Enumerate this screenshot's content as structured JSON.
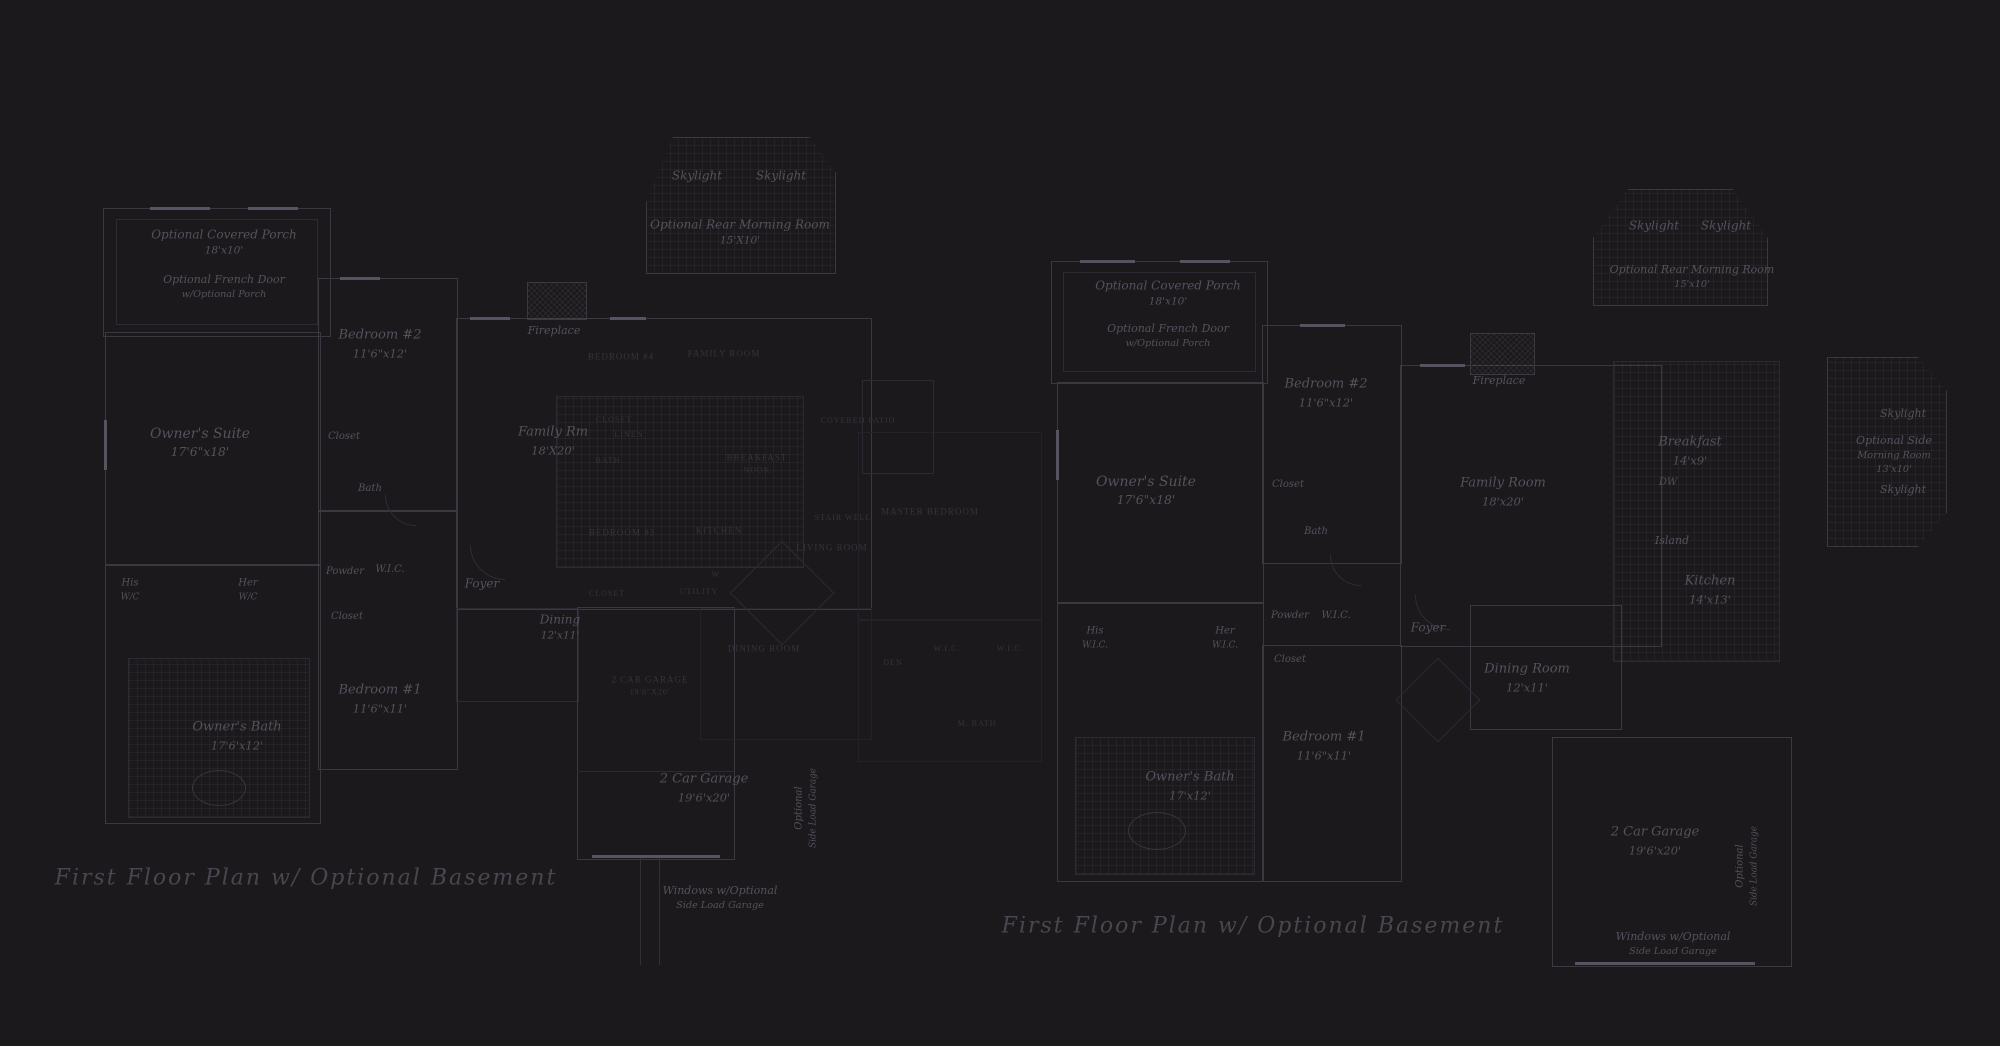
{
  "scene": {
    "description": "Two dark-themed architectural first-floor plan drawings on a charcoal sheet",
    "background_color": "#1b191b",
    "wall_color": "#3b3841",
    "label_color": "#56515e",
    "faded_label_color": "#37333d",
    "title_color": "#4a4550"
  },
  "plans": [
    {
      "id": "left-plan",
      "title": "First Floor Plan  w/ Optional Basement",
      "labels": {
        "skylight_a": [
          "Skylight"
        ],
        "skylight_b": [
          "Skylight"
        ],
        "rear_morning_room": [
          "Optional Rear Morning Room",
          "15'X10'"
        ],
        "covered_porch": [
          "Optional Covered Porch",
          "18'x10'"
        ],
        "french_door": [
          "Optional French Door",
          "w/Optional Porch"
        ],
        "owners_suite": [
          "Owner's Suite",
          "17'6\"x18'"
        ],
        "bedroom_2": [
          "Bedroom #2",
          "11'6\"x12'"
        ],
        "closet_bedroom_2": [
          "Closet"
        ],
        "bath": [
          "Bath"
        ],
        "fireplace": [
          "Fireplace"
        ],
        "family_rm": [
          "Family Rm",
          "18'X20'"
        ],
        "foyer": [
          "Foyer"
        ],
        "dining": [
          "Dining",
          "12'x11'"
        ],
        "bedroom_1": [
          "Bedroom #1",
          "11'6\"x11'"
        ],
        "owners_bath": [
          "Owner's Bath",
          "17'6'x12'"
        ],
        "his_wc": [
          "His",
          "W/C"
        ],
        "her_wc": [
          "Her",
          "W/C"
        ],
        "powder": [
          "Powder"
        ],
        "wic": [
          "W.I.C."
        ],
        "closet_hall": [
          "Closet"
        ],
        "garage": [
          "2 Car Garage",
          "19'6'x20'"
        ],
        "side_load_garage": [
          "Optional",
          "Side Load Garage"
        ],
        "windows_side_load": [
          "Windows w/Optional",
          "Side Load Garage"
        ],
        "ghost_bedroom_4": [
          "BEDROOM #4"
        ],
        "ghost_family_room": [
          "FAMILY ROOM"
        ],
        "ghost_closet": [
          "CLOSET"
        ],
        "ghost_linen": [
          "LINEN"
        ],
        "ghost_bath": [
          "BATH"
        ],
        "ghost_bedroom_3": [
          "BEDROOM #3"
        ],
        "ghost_kitchen": [
          "KITCHEN"
        ],
        "ghost_breakfast_nook": [
          "BREAKFAST",
          "NOOK"
        ],
        "ghost_living_room": [
          "LIVING ROOM"
        ],
        "ghost_covered_patio": [
          "COVERED PATIO"
        ],
        "ghost_closet_2": [
          "CLOSET"
        ],
        "ghost_utility": [
          "UTILITY"
        ],
        "ghost_washer": [
          "W"
        ],
        "ghost_dining_room": [
          "DINING ROOM"
        ],
        "ghost_garage": [
          "2 CAR GARAGE",
          "19'6\"X20'"
        ],
        "ghost_stair_well": [
          "STAIR WELL"
        ],
        "ghost_master_bedroom": [
          "MASTER BEDROOM"
        ],
        "ghost_wic_a": [
          "W.I.C."
        ],
        "ghost_wic_b": [
          "W.I.C."
        ],
        "ghost_m_bath": [
          "M. BATH"
        ],
        "ghost_den": [
          "DEN"
        ]
      }
    },
    {
      "id": "right-plan",
      "title": "First Floor Plan  w/ Optional Basement",
      "labels": {
        "skylight_a": [
          "Skylight"
        ],
        "skylight_b": [
          "Skylight"
        ],
        "rear_morning_room": [
          "Optional Rear Morning Room",
          "15'x10'"
        ],
        "covered_porch": [
          "Optional Covered Porch",
          "18'x10'"
        ],
        "french_door": [
          "Optional French Door",
          "w/Optional Porch"
        ],
        "bedroom_2": [
          "Bedroom #2",
          "11'6\"x12'"
        ],
        "owners_suite": [
          "Owner's Suite",
          "17'6\"x18'"
        ],
        "closet": [
          "Closet"
        ],
        "bath": [
          "Bath"
        ],
        "fireplace": [
          "Fireplace"
        ],
        "family_room": [
          "Family Room",
          "18'x20'"
        ],
        "breakfast": [
          "Breakfast",
          "14'x9'"
        ],
        "dw": [
          "DW"
        ],
        "island": [
          "Island"
        ],
        "kitchen": [
          "Kitchen",
          "14'x13'"
        ],
        "side_skylight_a": [
          "Skylight"
        ],
        "side_morning_room": [
          "Optional Side",
          "Morning Room",
          "13'x10'"
        ],
        "side_skylight_b": [
          "Skylight"
        ],
        "dining_room": [
          "Dining Room",
          "12'x11'"
        ],
        "foyer": [
          "Foyer"
        ],
        "powder": [
          "Powder"
        ],
        "wic": [
          "W.I.C."
        ],
        "closet_hall": [
          "Closet"
        ],
        "his_wic": [
          "His",
          "W.I.C."
        ],
        "her_wic": [
          "Her",
          "W.I.C."
        ],
        "bedroom_1": [
          "Bedroom #1",
          "11'6\"x11'"
        ],
        "owners_bath": [
          "Owner's Bath",
          "17'x12'"
        ],
        "garage": [
          "2 Car Garage",
          "19'6'x20'"
        ],
        "side_load_garage": [
          "Optional",
          "Side Load Garage"
        ],
        "windows_side_load": [
          "Windows w/Optional",
          "Side Load Garage"
        ]
      }
    }
  ]
}
